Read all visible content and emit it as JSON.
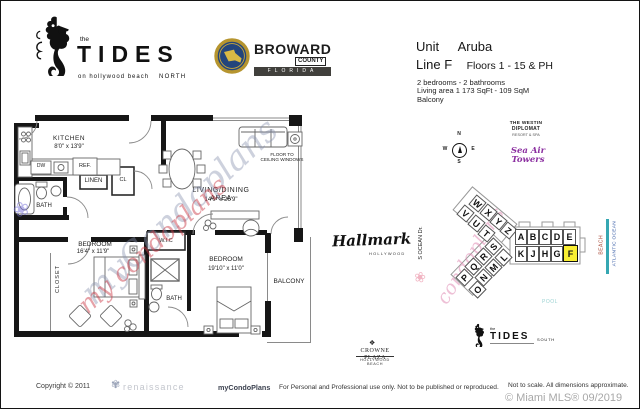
{
  "header": {
    "tides_logo": {
      "the": "the",
      "name": "TIDES",
      "tagline": "on hollywood beach",
      "region": "NORTH"
    },
    "broward": {
      "name": "BROWARD",
      "county": "COUNTY",
      "state": "FLORIDA"
    },
    "unit_info": {
      "unit_label": "Unit",
      "unit_name": "Aruba",
      "line": "Line F",
      "floors": "Floors 1 - 15 & PH",
      "beds": "2 bedrooms - 2 bathrooms",
      "area": "Living area  1 173  SqFt - 109  SqM",
      "balcony": "Balcony"
    }
  },
  "floorplan": {
    "kitchen": {
      "name": "KITCHEN",
      "dims": "8'0\" x 13'9\""
    },
    "living": {
      "name": "LIVING/DINING  AREA",
      "dims": "14'0\" x 26'9\""
    },
    "bedroom1": {
      "name": "BEDROOM",
      "dims": "16'4\" x 11'9\""
    },
    "bedroom2": {
      "name": "BEDROOM",
      "dims": "19'10\" x 11'0\""
    },
    "balcony": "BALCONY",
    "bath1": "BATH",
    "bath2": "BATH",
    "wic": "W.I.C",
    "linen": "LINEN",
    "cl": "CL",
    "closet": "CLOSET",
    "dw": "DW",
    "ref": "REF.",
    "windows_note1": "FLOOR TO",
    "windows_note2": "CEILING WINDOWS",
    "watermark_main": "myCondoplans",
    "watermark_red": "my condoplans",
    "watermark_pink": "condoplans"
  },
  "map": {
    "westin1": "THE WESTIN",
    "westin2": "DIPLOMAT",
    "westin3": "RESORT & SPA",
    "sea_air": "Sea Air Towers",
    "compass": {
      "n": "N",
      "w": "W",
      "e": "E",
      "s": "S"
    },
    "street": "S OCEAN Dr.",
    "pool": "POOL",
    "beach": "BEACH",
    "ocean": "ATLANTIC OCEAN",
    "tides_south": {
      "the": "the",
      "name": "TIDES",
      "region": "SOUTH"
    },
    "highlight_color": "#f9ee32",
    "cells": [
      {
        "l": "W",
        "x": 470,
        "y": 196,
        "r": 40
      },
      {
        "l": "X",
        "x": 481,
        "y": 205,
        "r": 40
      },
      {
        "l": "Y",
        "x": 491,
        "y": 214,
        "r": 40
      },
      {
        "l": "Z",
        "x": 501,
        "y": 223,
        "r": 40
      },
      {
        "l": "V",
        "x": 458,
        "y": 206,
        "r": 40
      },
      {
        "l": "U",
        "x": 469,
        "y": 216,
        "r": 40
      },
      {
        "l": "T",
        "x": 479,
        "y": 226,
        "r": 40
      },
      {
        "l": "S",
        "x": 486,
        "y": 239,
        "r": -46
      },
      {
        "l": "R",
        "x": 476,
        "y": 249,
        "r": -46
      },
      {
        "l": "Q",
        "x": 466,
        "y": 259,
        "r": -46
      },
      {
        "l": "P",
        "x": 457,
        "y": 270,
        "r": -46
      },
      {
        "l": "L",
        "x": 496,
        "y": 250,
        "r": -46
      },
      {
        "l": "M",
        "x": 486,
        "y": 260,
        "r": -46
      },
      {
        "l": "N",
        "x": 476,
        "y": 270,
        "r": -46
      },
      {
        "l": "O",
        "x": 470,
        "y": 282,
        "r": -46
      },
      {
        "l": "A",
        "x": 514,
        "y": 228,
        "r": 0,
        "w": 12,
        "h": 16
      },
      {
        "l": "B",
        "x": 526,
        "y": 228,
        "r": 0,
        "w": 12,
        "h": 16
      },
      {
        "l": "C",
        "x": 538,
        "y": 228,
        "r": 0,
        "w": 12,
        "h": 16
      },
      {
        "l": "D",
        "x": 550,
        "y": 228,
        "r": 0,
        "w": 12,
        "h": 16
      },
      {
        "l": "E",
        "x": 562,
        "y": 228,
        "r": 0,
        "w": 13,
        "h": 16
      },
      {
        "l": "K",
        "x": 514,
        "y": 245,
        "r": 0,
        "w": 12,
        "h": 16
      },
      {
        "l": "J",
        "x": 526,
        "y": 245,
        "r": 0,
        "w": 12,
        "h": 16
      },
      {
        "l": "H",
        "x": 538,
        "y": 245,
        "r": 0,
        "w": 12,
        "h": 16
      },
      {
        "l": "G",
        "x": 550,
        "y": 245,
        "r": 0,
        "w": 12,
        "h": 16
      },
      {
        "l": "F",
        "x": 562,
        "y": 244,
        "r": 0,
        "w": 15,
        "h": 17,
        "hl": true
      }
    ]
  },
  "landmarks": {
    "hallmark": {
      "name": "Hallmark",
      "sub": "HOLLYWOOD"
    },
    "crowne": {
      "name": "CROWNE PLAZA",
      "sub": "HOLLYWOOD BEACH"
    }
  },
  "footer": {
    "copyright": "Copyright © 2011",
    "renaissance": "renaissance",
    "brand": "myCondoPlans",
    "usage": "For Personal and Professional use only.  Not to be published or reproduced.",
    "scale_note": "Not to scale.  All dimensions approximate.",
    "mls": "© Miami MLS® 09/2019"
  }
}
